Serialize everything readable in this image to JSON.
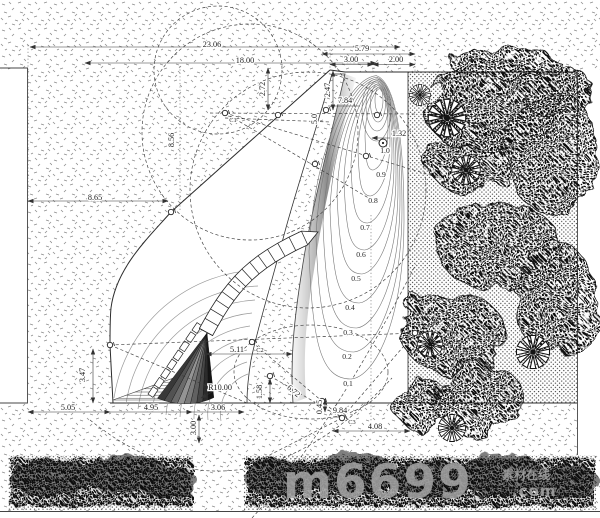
{
  "drawing": {
    "kind": "landscape-site-plan-cad-drawing",
    "units_note": "dimensionless CAD measurements"
  },
  "colors": {
    "paper": "#ffffff",
    "line": "#333333",
    "dim_text": "#1c1c1c",
    "contour_line": "#777777",
    "foliage": "#141414",
    "watermark": "#a2a2a2"
  },
  "watermark": {
    "brand": "m6699",
    "suffix_line1": "素材在线",
    "suffix_line2": ".com"
  },
  "dimension_labels": [
    {
      "text": "23.06",
      "x": 212,
      "y": 47,
      "rot": 0
    },
    {
      "text": "18.00",
      "x": 245,
      "y": 63,
      "rot": 0
    },
    {
      "text": "5.79",
      "x": 362,
      "y": 51,
      "rot": 0
    },
    {
      "text": "3.00",
      "x": 351,
      "y": 62,
      "rot": 0
    },
    {
      "text": "2.00",
      "x": 396,
      "y": 62,
      "rot": 0
    },
    {
      "text": "2.72",
      "x": 265,
      "y": 89,
      "rot": -90
    },
    {
      "text": "2.47",
      "x": 330,
      "y": 90,
      "rot": -90
    },
    {
      "text": "7.84",
      "x": 345,
      "y": 103,
      "rot": 0
    },
    {
      "text": "5.0",
      "x": 317,
      "y": 119,
      "rot": -90
    },
    {
      "text": "1.32",
      "x": 399,
      "y": 136,
      "rot": 0
    },
    {
      "text": "8.65",
      "x": 95,
      "y": 200,
      "rot": 0
    },
    {
      "text": "8.56",
      "x": 174,
      "y": 140,
      "rot": -90
    },
    {
      "text": "5.11",
      "x": 237,
      "y": 352,
      "rot": 0
    },
    {
      "text": "R10.00",
      "x": 220,
      "y": 390,
      "rot": 0
    },
    {
      "text": "3.47",
      "x": 85,
      "y": 375,
      "rot": -90
    },
    {
      "text": "1.58",
      "x": 262,
      "y": 392,
      "rot": -90
    },
    {
      "text": "6.72",
      "x": 292,
      "y": 393,
      "rot": 40
    },
    {
      "text": "5.05",
      "x": 68,
      "y": 410,
      "rot": 0
    },
    {
      "text": "4.95",
      "x": 151,
      "y": 410,
      "rot": 0
    },
    {
      "text": "3.06",
      "x": 218,
      "y": 410,
      "rot": 0
    },
    {
      "text": "3.00",
      "x": 196,
      "y": 428,
      "rot": -90
    },
    {
      "text": "0.45",
      "x": 322,
      "y": 407,
      "rot": -90
    },
    {
      "text": "9.84",
      "x": 340,
      "y": 413,
      "rot": 0
    },
    {
      "text": "4.08",
      "x": 375,
      "y": 429,
      "rot": 0
    }
  ],
  "contour_labels": [
    {
      "text": "0.1",
      "x": 348,
      "y": 386
    },
    {
      "text": "0.2",
      "x": 347,
      "y": 359
    },
    {
      "text": "0.3",
      "x": 348,
      "y": 335
    },
    {
      "text": "0.4",
      "x": 350,
      "y": 310
    },
    {
      "text": "0.5",
      "x": 356,
      "y": 281
    },
    {
      "text": "0.6",
      "x": 361,
      "y": 257
    },
    {
      "text": "0.7",
      "x": 365,
      "y": 230
    },
    {
      "text": "0.8",
      "x": 373,
      "y": 203
    },
    {
      "text": "0.9",
      "x": 381,
      "y": 177
    }
  ],
  "spot_elevation": {
    "text": "1.0",
    "x": 385,
    "y": 153
  },
  "point_labels": [
    {
      "text": "C1",
      "x": 233,
      "y": 122
    },
    {
      "text": "C2",
      "x": 260,
      "y": 352
    },
    {
      "text": "C3",
      "x": 352,
      "y": 424
    }
  ],
  "survey_points": [
    {
      "x": 225,
      "y": 113
    },
    {
      "x": 278,
      "y": 115
    },
    {
      "x": 326,
      "y": 110
    },
    {
      "x": 377,
      "y": 115
    },
    {
      "x": 171,
      "y": 212
    },
    {
      "x": 315,
      "y": 164
    },
    {
      "x": 366,
      "y": 156
    },
    {
      "x": 110,
      "y": 345
    },
    {
      "x": 252,
      "y": 342
    },
    {
      "x": 415,
      "y": 333
    },
    {
      "x": 270,
      "y": 376
    },
    {
      "x": 322,
      "y": 401
    },
    {
      "x": 342,
      "y": 418
    }
  ]
}
